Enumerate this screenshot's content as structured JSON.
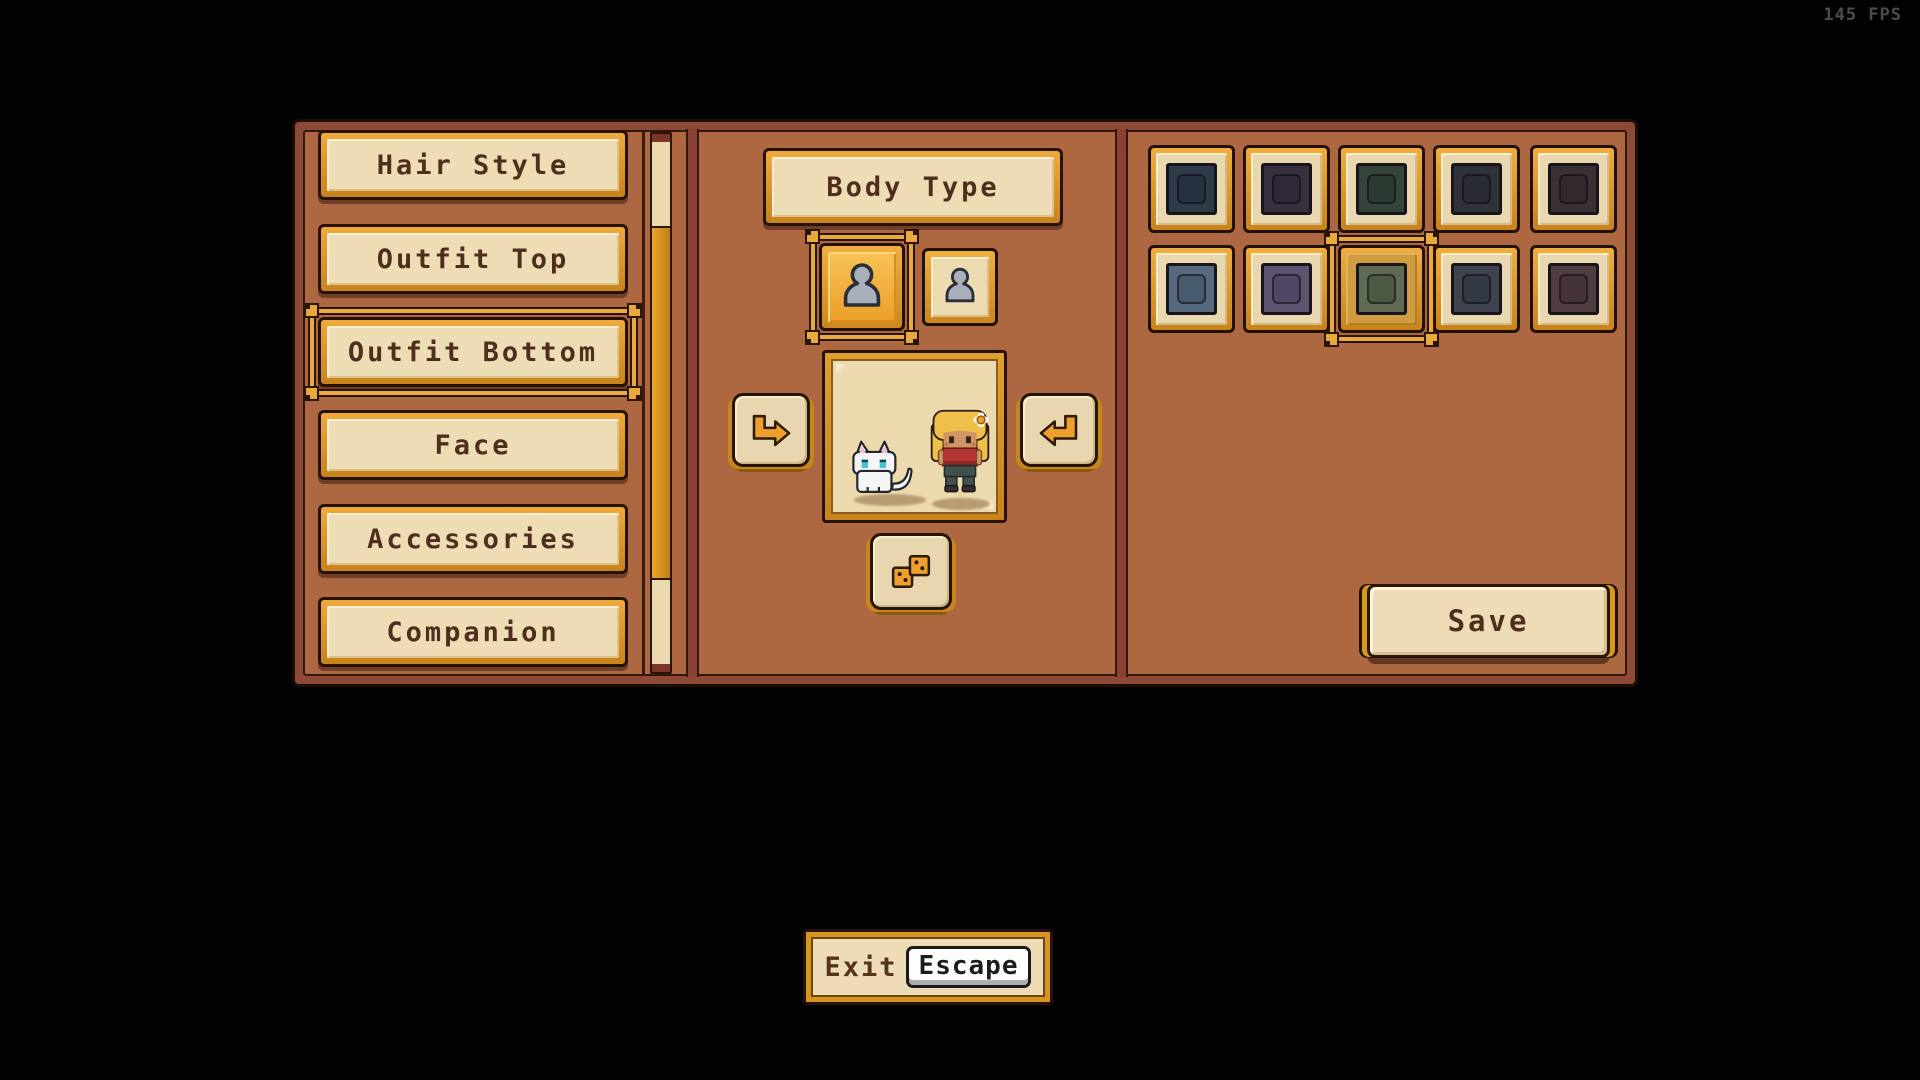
{
  "hud": {
    "fps": "145 FPS"
  },
  "sidebar": {
    "items": [
      {
        "label": "Hair Style",
        "selected": false
      },
      {
        "label": "Outfit Top",
        "selected": false
      },
      {
        "label": "Outfit Bottom",
        "selected": true
      },
      {
        "label": "Face",
        "selected": false
      },
      {
        "label": "Accessories",
        "selected": false
      },
      {
        "label": "Companion",
        "selected": false
      }
    ]
  },
  "body_type": {
    "title": "Body Type",
    "options": [
      {
        "id": "body-type-a",
        "selected": true
      },
      {
        "id": "body-type-b",
        "selected": false
      }
    ]
  },
  "preview": {
    "companion": "white-cat",
    "character": "blonde-girl-red-top-flower"
  },
  "palette": {
    "selected_index": 7,
    "swatches": [
      {
        "name": "dark-blue",
        "outer": "#2e3b48",
        "inner": "#273240",
        "selected": false
      },
      {
        "name": "dark-purple",
        "outer": "#38303f",
        "inner": "#2f2837",
        "selected": false
      },
      {
        "name": "dark-green",
        "outer": "#35443a",
        "inner": "#2b3a31",
        "selected": false
      },
      {
        "name": "dark-gray",
        "outer": "#2f3238",
        "inner": "#282b31",
        "selected": false
      },
      {
        "name": "dark-maroon",
        "outer": "#3b3034",
        "inner": "#32292e",
        "selected": false
      },
      {
        "name": "blue",
        "outer": "#56697e",
        "inner": "#485a6d",
        "selected": false
      },
      {
        "name": "purple",
        "outer": "#5e5370",
        "inner": "#4f4763",
        "selected": false
      },
      {
        "name": "green",
        "outer": "#5f6b52",
        "inner": "#4d5a43",
        "selected": true
      },
      {
        "name": "gray",
        "outer": "#3e434d",
        "inner": "#343a44",
        "selected": false
      },
      {
        "name": "maroon",
        "outer": "#503c41",
        "inner": "#443338",
        "selected": false
      }
    ]
  },
  "save": {
    "label": "Save"
  },
  "exit": {
    "label": "Exit",
    "key_hint": "Escape"
  },
  "colors": {
    "panel_bg": "#ad6741",
    "panel_border": "#8d4a37",
    "gold": "#d9952e",
    "cream": "#eedcb4",
    "text_brown": "#4f2e1d",
    "selection_gold": "#eaa93d",
    "arrow_orange": "#ef9f2d",
    "fps_gray": "#4c4c4c"
  }
}
